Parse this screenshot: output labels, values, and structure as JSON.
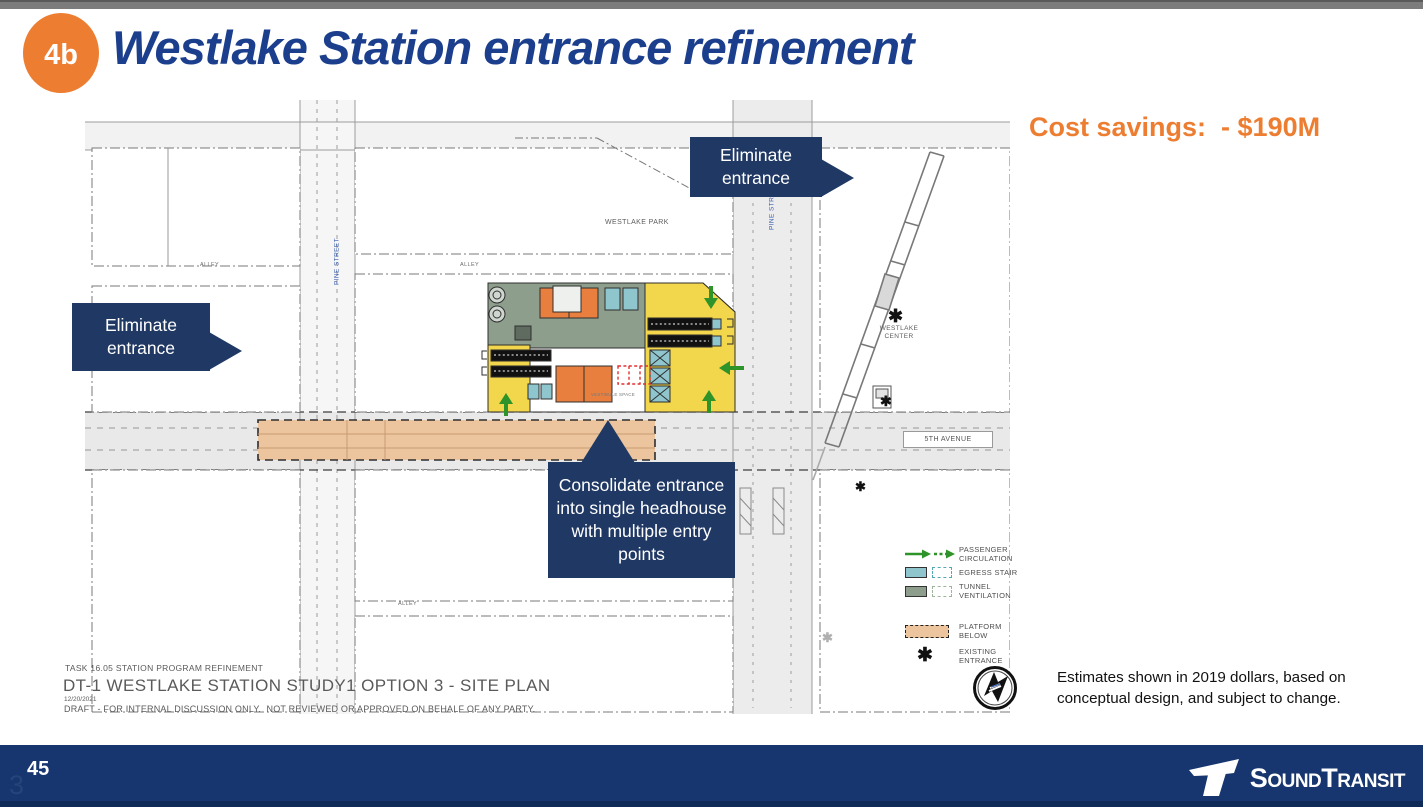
{
  "header": {
    "badge": "4b",
    "title": "Westlake Station entrance refinement"
  },
  "cost_savings": "Cost savings:  - $190M",
  "callouts": {
    "eliminate_top": "Eliminate entrance",
    "eliminate_left": "Eliminate entrance",
    "consolidate": "Consolidate entrance into single headhouse with multiple entry points"
  },
  "plan": {
    "labels": {
      "westlake_park": "WESTLAKE PARK",
      "westlake_center": "WESTLAKE CENTER",
      "pine_street": "PINE STREET",
      "fifth_avenue": "5TH AVENUE",
      "alley": "ALLEY",
      "vestibule": "VESTIBULE SPACE"
    },
    "existing_entrance_marker": "✱",
    "title_block": {
      "task": "TASK 16.05 STATION PROGRAM REFINEMENT",
      "drawing_title": "DT-1 WESTLAKE STATION STUDY1 OPTION 3 - SITE PLAN",
      "date": "12/20/2021",
      "draft_note": "DRAFT - FOR INTERNAL DISCUSSION ONLY.  NOT REVIEWED OR APPROVED ON BEHALF OF ANY PARTY."
    }
  },
  "legend": {
    "passenger_circulation": "PASSENGER CIRCULATION",
    "egress_stair": "EGRESS STAIR",
    "tunnel_ventilation": "TUNNEL VENTILATION",
    "platform_below": "PLATFORM BELOW",
    "existing_entrance": "EXISTING ENTRANCE"
  },
  "disclaimer": "Estimates shown in 2019 dollars, based on conceptual design, and subject to change.",
  "footer": {
    "page_number": "45",
    "ghost_number": "3",
    "logo": {
      "word1": "Sound",
      "word2": "Transit"
    }
  },
  "colors": {
    "accent_orange": "#ED7D31",
    "title_blue": "#1B3E8D",
    "callout_navy": "#1F3864",
    "footer_navy": "#17356E",
    "plan_yellow": "#F2D64B",
    "plan_sage": "#8E9E8C",
    "plan_orange": "#E87F3F",
    "plan_teal": "#8FC6CE",
    "platform_tan": "#ECC49E",
    "arrow_green": "#2E9329"
  }
}
